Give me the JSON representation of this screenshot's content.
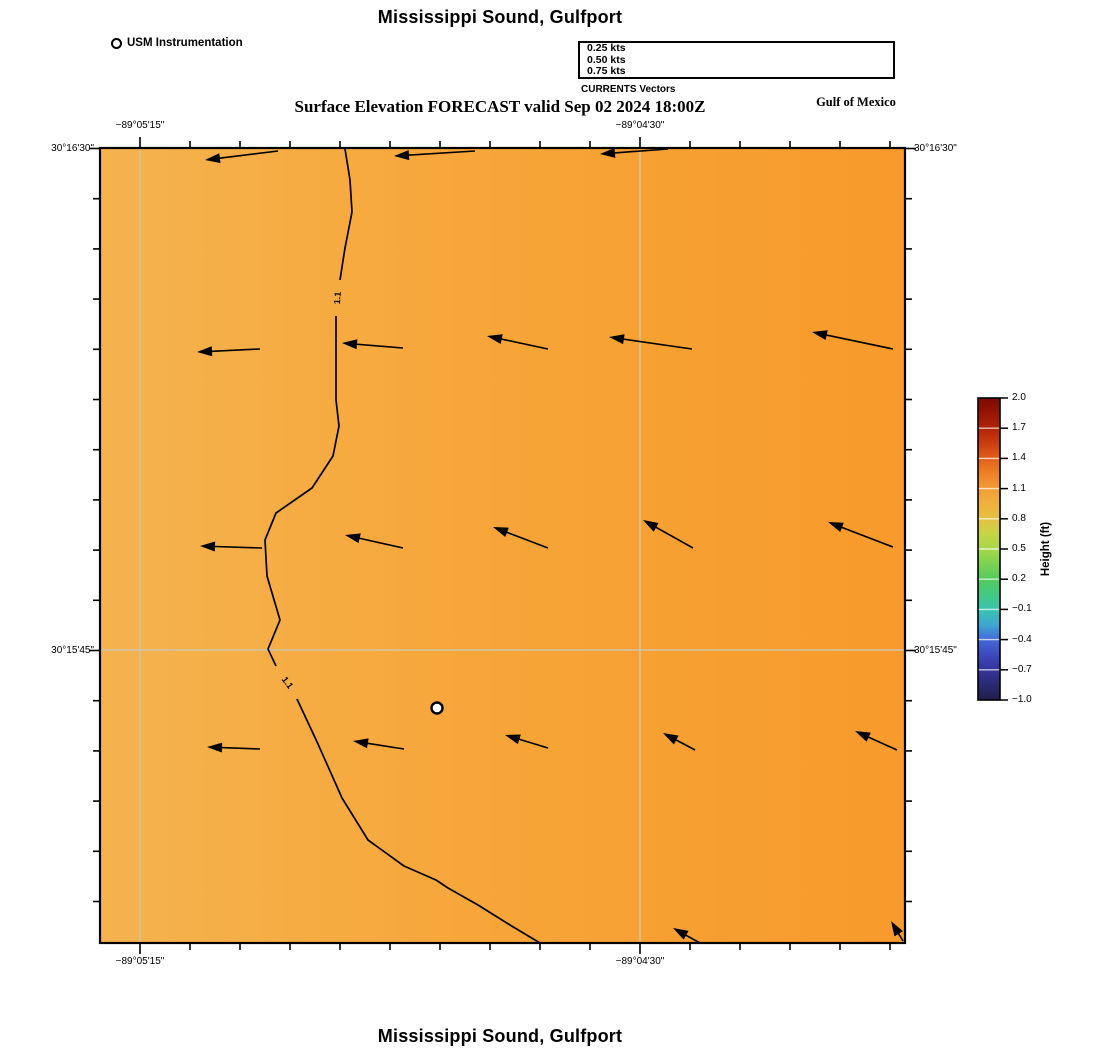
{
  "page": {
    "title_top": "Mississippi Sound, Gulfport",
    "title_bottom": "Mississippi Sound, Gulfport",
    "subtitle": "Surface Elevation FORECAST valid Sep 02 2024 18:00Z",
    "region_label": "Gulf of Mexico"
  },
  "station": {
    "label": "USM Instrumentation"
  },
  "legend": {
    "caption": "CURRENTS Vectors",
    "tip_x": 888,
    "items": [
      {
        "label": "0.25 kts",
        "x1": 803,
        "y": 47.5
      },
      {
        "label": "0.50 kts",
        "x1": 722,
        "y": 59
      },
      {
        "label": "0.75 kts",
        "x1": 641,
        "y": 70.5
      }
    ]
  },
  "chart_data": {
    "type": "heatmap",
    "title": "Mississippi Sound, Gulfport",
    "subtitle": "Surface Elevation FORECAST valid Sep 02 2024 18:00Z",
    "map": {
      "left": 100,
      "top": 148,
      "width": 805,
      "height": 795,
      "border_color": "#000000",
      "fill_stops": [
        [
          0,
          "#f4b350"
        ],
        [
          0.25,
          "#f6ac43"
        ],
        [
          0.5,
          "#f7a538"
        ],
        [
          0.75,
          "#f79f31"
        ],
        [
          1,
          "#f89a2c"
        ]
      ]
    },
    "grid": {
      "color": "#cfc5a8",
      "x_lines": [
        140,
        640
      ],
      "y_lines": [
        650
      ]
    },
    "axes": {
      "x_ticks_major": [
        {
          "label": "−89°05'15\"",
          "x": 140
        },
        {
          "label": "−89°04'30\"",
          "x": 640
        }
      ],
      "y_ticks_major": [
        {
          "label": "30°16'30\"",
          "y": 148.5
        },
        {
          "label": "30°15'45\"",
          "y": 650.5
        }
      ],
      "x_minor": {
        "start": 140,
        "step": 50,
        "count": 16
      },
      "y_minor": {
        "start": 148.5,
        "step": 50.2,
        "count": 16
      }
    },
    "contour": {
      "value": "1.1",
      "segments": [
        [
          [
            345,
            149
          ],
          [
            350,
            180
          ],
          [
            352,
            212
          ],
          [
            345,
            248
          ],
          [
            340,
            280
          ]
        ],
        [
          [
            336,
            316
          ],
          [
            336,
            400
          ],
          [
            339,
            426
          ],
          [
            333,
            456
          ],
          [
            312,
            488
          ],
          [
            276,
            513
          ],
          [
            265,
            540
          ],
          [
            267,
            576
          ],
          [
            280,
            620
          ],
          [
            268,
            649
          ],
          [
            276,
            666
          ]
        ],
        [
          [
            297,
            699
          ],
          [
            318,
            744
          ],
          [
            342,
            798
          ],
          [
            368,
            840
          ],
          [
            404,
            866
          ],
          [
            436,
            880
          ],
          [
            448,
            888
          ],
          [
            478,
            905
          ],
          [
            510,
            925
          ],
          [
            540,
            943
          ]
        ]
      ],
      "labels": [
        {
          "text": "1.1",
          "x": 338,
          "y": 298,
          "rot": -86
        },
        {
          "text": "1.1",
          "x": 287,
          "y": 683,
          "rot": 54
        }
      ]
    },
    "vectors": [
      [
        278,
        151,
        205,
        160
      ],
      [
        475,
        151,
        394,
        156
      ],
      [
        668,
        149,
        600,
        154
      ],
      [
        260,
        349,
        197,
        352
      ],
      [
        403,
        348,
        342,
        343
      ],
      [
        548,
        349,
        487,
        336
      ],
      [
        692,
        349,
        609,
        337
      ],
      [
        893,
        349,
        812,
        332
      ],
      [
        262,
        548,
        200,
        546
      ],
      [
        403,
        548,
        345,
        535
      ],
      [
        548,
        548,
        493,
        527
      ],
      [
        693,
        548,
        643,
        520
      ],
      [
        893,
        547,
        828,
        522
      ],
      [
        260,
        749,
        207,
        747
      ],
      [
        404,
        749,
        353,
        741
      ],
      [
        548,
        748,
        505,
        735
      ],
      [
        695,
        750,
        663,
        733
      ],
      [
        897,
        750,
        855,
        731
      ],
      [
        700,
        943,
        673,
        928
      ],
      [
        903,
        941,
        891,
        921
      ]
    ],
    "station_marker": {
      "x": 437,
      "y": 708
    },
    "colorbar": {
      "title": "Height (ft)",
      "x": 978,
      "y": 398,
      "w": 22,
      "h": 302,
      "tick_labels": [
        "2.0",
        "1.7",
        "1.4",
        "1.1",
        "0.8",
        "0.5",
        "0.2",
        "−0.1",
        "−0.4",
        "−0.7",
        "−1.0"
      ],
      "stops": [
        [
          0,
          "#7b0903"
        ],
        [
          0.05,
          "#971505"
        ],
        [
          0.1,
          "#b02408"
        ],
        [
          0.15,
          "#cb3d10"
        ],
        [
          0.2,
          "#e0601a"
        ],
        [
          0.25,
          "#ee8126"
        ],
        [
          0.3,
          "#f29d35"
        ],
        [
          0.35,
          "#eeb13c"
        ],
        [
          0.4,
          "#e7c043"
        ],
        [
          0.45,
          "#c6d545"
        ],
        [
          0.5,
          "#a6d747"
        ],
        [
          0.55,
          "#7cd251"
        ],
        [
          0.6,
          "#55cb5b"
        ],
        [
          0.65,
          "#42c983"
        ],
        [
          0.7,
          "#3ac4ae"
        ],
        [
          0.75,
          "#3fa7d2"
        ],
        [
          0.8,
          "#4569d8"
        ],
        [
          0.85,
          "#3c49bd"
        ],
        [
          0.9,
          "#35349c"
        ],
        [
          0.95,
          "#2a2a72"
        ],
        [
          1,
          "#221d4b"
        ]
      ]
    }
  }
}
